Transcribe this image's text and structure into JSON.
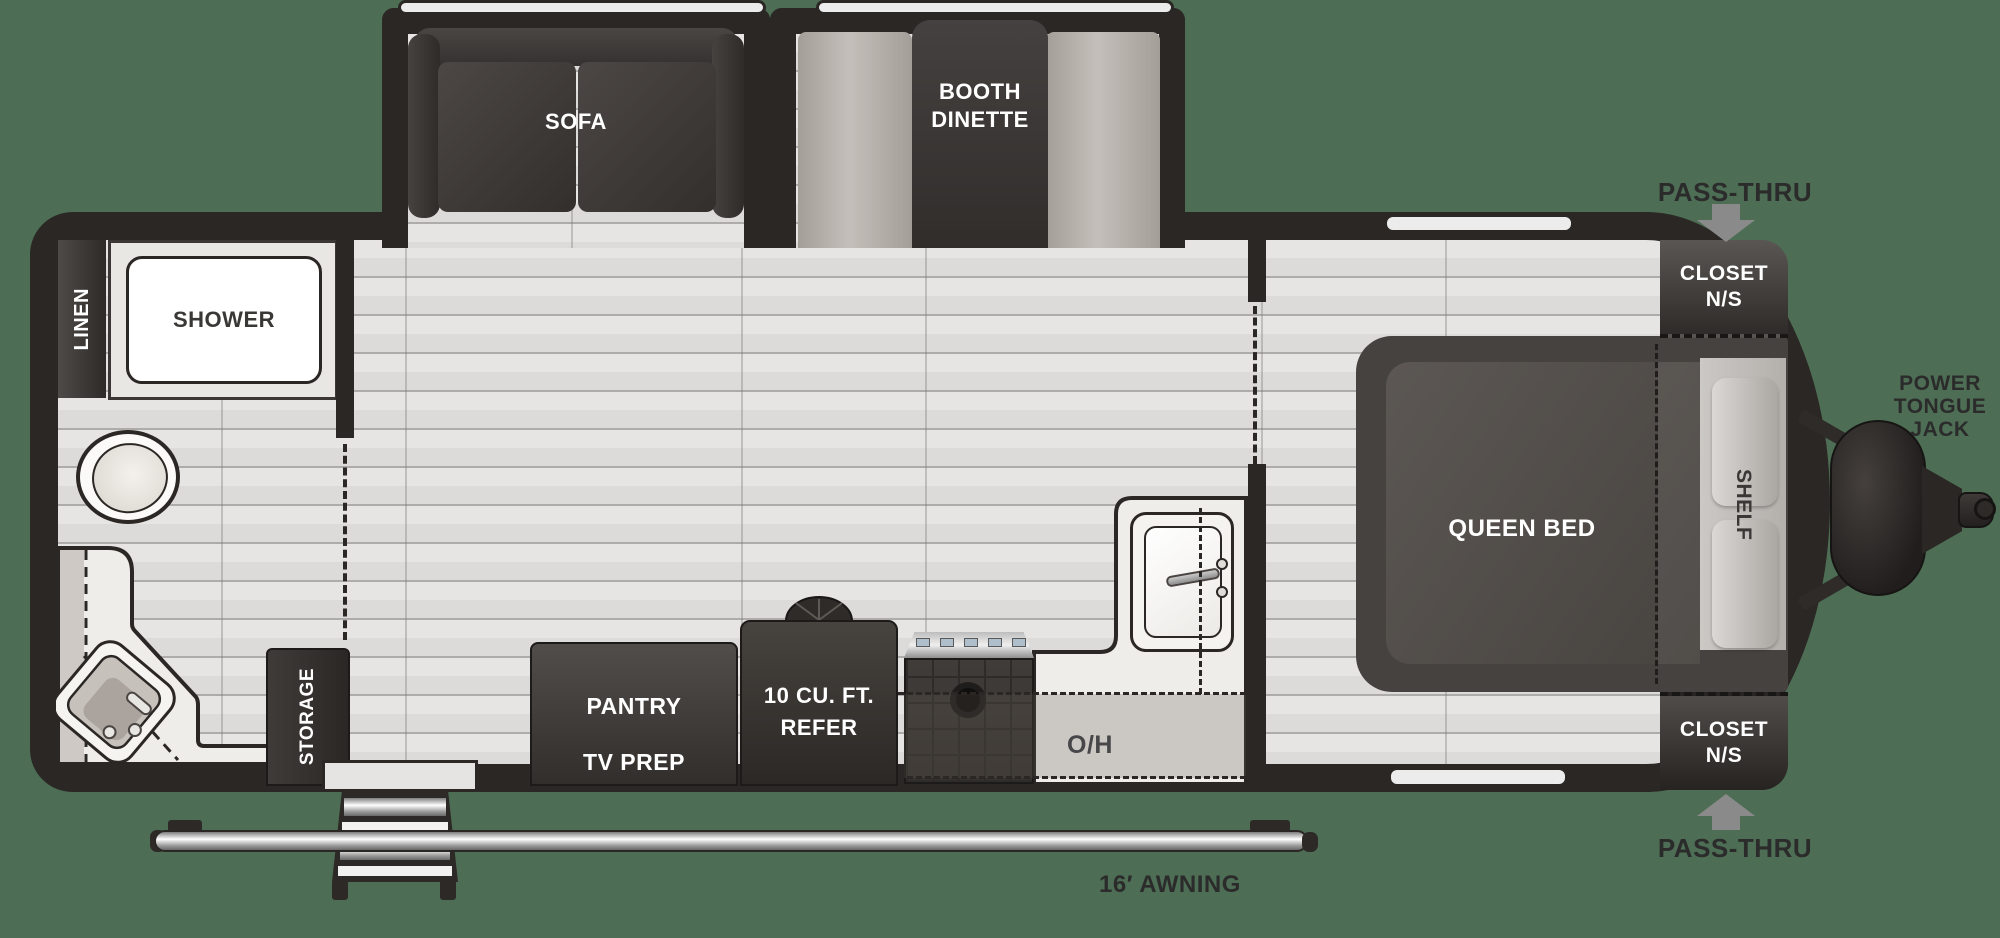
{
  "trailer": {
    "slideouts": {
      "sofa": "SOFA",
      "dinette_l1": "BOOTH",
      "dinette_l2": "DINETTE"
    },
    "bath": {
      "linen": "LINEN",
      "shower": "SHOWER"
    },
    "kitchen": {
      "storage": "STORAGE",
      "pantry": "PANTRY",
      "tv_prep": "TV PREP",
      "refer_l1": "10 CU. FT.",
      "refer_l2": "REFER",
      "overhead": "O/H"
    },
    "bedroom": {
      "bed": "QUEEN BED",
      "shelf": "SHELF",
      "closet_top_l1": "CLOSET",
      "closet_top_l2": "N/S",
      "closet_bottom_l1": "CLOSET",
      "closet_bottom_l2": "N/S"
    },
    "exterior": {
      "pass_thru_top": "PASS-THRU",
      "pass_thru_bottom": "PASS-THRU",
      "jack_l1": "POWER",
      "jack_l2": "TONGUE",
      "jack_l3": "JACK",
      "awning": "16′ AWNING"
    }
  },
  "colors": {
    "background": "#4D6E54",
    "wall": "#2B2725",
    "dark_furniture": "#3B3734",
    "floor": "#DEDDDB",
    "counter": "#EFEDEA",
    "bench": "#ABA5A0",
    "arrow": "#8A8A8A",
    "text_dark": "#2B2B2C",
    "text_white": "#FFFFFF"
  }
}
